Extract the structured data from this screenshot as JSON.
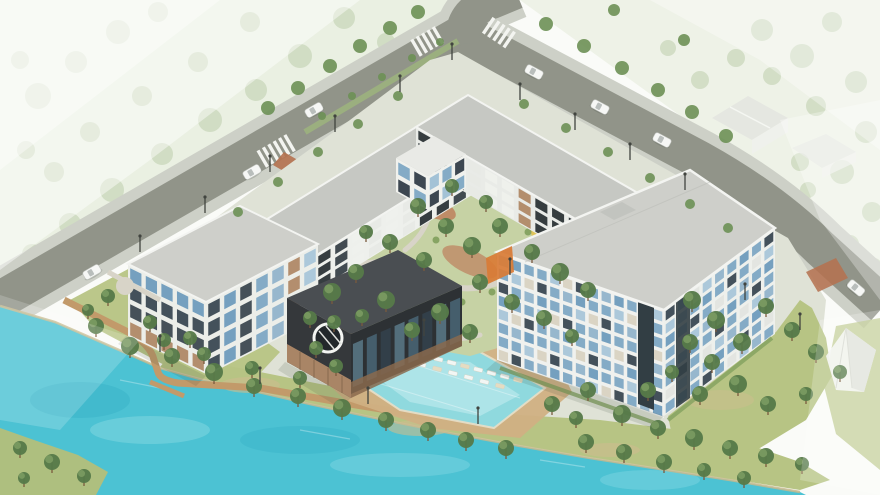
{
  "scene": {
    "type": "architectural-aerial-rendering",
    "description": "Isometric aerial rendering of a lakeside residential complex: U-shaped mid-rise buildings around a landscaped courtyard, dark clubhouse with round window, outdoor pool with loungers, turquoise lake with boardwalk, tree-lined boulevard with crosswalks and cars, faded context houses in mist",
    "features": [
      "lake",
      "swimming-pool",
      "pool-loungers",
      "lakeside-boardwalk",
      "dock",
      "courtyard-garden",
      "playground",
      "clubhouse-round-window",
      "west-residence-4-story",
      "courtyard-wings-3-story",
      "east-tower-8-story",
      "boulevard-with-median",
      "intersection-crosswalks",
      "brick-crossing",
      "street-lights",
      "cars",
      "event-tent",
      "context-houses",
      "misty-parkland"
    ],
    "trees": {
      "faded": [
        [
          38,
          96,
          13
        ],
        [
          76,
          62,
          11
        ],
        [
          118,
          32,
          12
        ],
        [
          158,
          12,
          10
        ],
        [
          210,
          120,
          12
        ],
        [
          162,
          154,
          11
        ],
        [
          112,
          190,
          12
        ],
        [
          70,
          224,
          11
        ],
        [
          32,
          254,
          10
        ],
        [
          256,
          90,
          11
        ],
        [
          300,
          56,
          12
        ],
        [
          344,
          18,
          11
        ],
        [
          386,
          42,
          9
        ],
        [
          142,
          96,
          10
        ],
        [
          198,
          62,
          10
        ],
        [
          250,
          22,
          10
        ],
        [
          90,
          132,
          10
        ],
        [
          54,
          172,
          10
        ],
        [
          26,
          150,
          9
        ],
        [
          20,
          60,
          9
        ],
        [
          762,
          30,
          11
        ],
        [
          802,
          56,
          12
        ],
        [
          832,
          22,
          10
        ],
        [
          856,
          82,
          11
        ],
        [
          816,
          106,
          10
        ],
        [
          866,
          132,
          11
        ],
        [
          842,
          172,
          12
        ],
        [
          872,
          212,
          10
        ],
        [
          800,
          162,
          9
        ],
        [
          772,
          76,
          9
        ],
        [
          736,
          58,
          9
        ],
        [
          746,
          162,
          8
        ],
        [
          850,
          244,
          9
        ],
        [
          874,
          266,
          8
        ],
        [
          808,
          190,
          8
        ],
        [
          700,
          80,
          9
        ],
        [
          668,
          48,
          8
        ]
      ],
      "street": [
        [
          268,
          108,
          7
        ],
        [
          298,
          88,
          7
        ],
        [
          330,
          66,
          7
        ],
        [
          360,
          46,
          7
        ],
        [
          390,
          28,
          7
        ],
        [
          418,
          12,
          7
        ],
        [
          322,
          116,
          4
        ],
        [
          352,
          96,
          4
        ],
        [
          382,
          77,
          4
        ],
        [
          412,
          58,
          4
        ],
        [
          440,
          42,
          4
        ],
        [
          238,
          212,
          5
        ],
        [
          278,
          182,
          5
        ],
        [
          318,
          152,
          5
        ],
        [
          358,
          124,
          5
        ],
        [
          398,
          96,
          5
        ],
        [
          546,
          24,
          7
        ],
        [
          584,
          46,
          7
        ],
        [
          622,
          68,
          7
        ],
        [
          658,
          90,
          7
        ],
        [
          692,
          112,
          7
        ],
        [
          726,
          136,
          7
        ],
        [
          614,
          10,
          6
        ],
        [
          684,
          40,
          6
        ],
        [
          524,
          104,
          5
        ],
        [
          566,
          128,
          5
        ],
        [
          608,
          152,
          5
        ],
        [
          650,
          178,
          5
        ],
        [
          690,
          204,
          5
        ],
        [
          728,
          228,
          5
        ]
      ],
      "site": [
        [
          332,
          292,
          9
        ],
        [
          356,
          272,
          8
        ],
        [
          386,
          300,
          9
        ],
        [
          362,
          316,
          7
        ],
        [
          412,
          330,
          8
        ],
        [
          440,
          312,
          9
        ],
        [
          470,
          332,
          8
        ],
        [
          334,
          322,
          7
        ],
        [
          418,
          206,
          8
        ],
        [
          446,
          226,
          8
        ],
        [
          472,
          246,
          9
        ],
        [
          500,
          226,
          8
        ],
        [
          532,
          252,
          8
        ],
        [
          560,
          272,
          9
        ],
        [
          588,
          290,
          8
        ],
        [
          480,
          282,
          8
        ],
        [
          512,
          302,
          8
        ],
        [
          452,
          186,
          7
        ],
        [
          486,
          202,
          7
        ],
        [
          390,
          242,
          8
        ],
        [
          366,
          232,
          7
        ],
        [
          424,
          260,
          8
        ],
        [
          544,
          318,
          8
        ],
        [
          572,
          336,
          7
        ],
        [
          96,
          326,
          8
        ],
        [
          130,
          346,
          9
        ],
        [
          172,
          356,
          8
        ],
        [
          214,
          372,
          9
        ],
        [
          254,
          386,
          8
        ],
        [
          150,
          322,
          7
        ],
        [
          190,
          338,
          7
        ],
        [
          298,
          396,
          8
        ],
        [
          342,
          408,
          9
        ],
        [
          386,
          420,
          8
        ],
        [
          428,
          430,
          8
        ],
        [
          300,
          378,
          7
        ],
        [
          252,
          368,
          7
        ],
        [
          204,
          354,
          7
        ],
        [
          164,
          340,
          7
        ],
        [
          466,
          440,
          8
        ],
        [
          506,
          448,
          8
        ],
        [
          586,
          442,
          8
        ],
        [
          624,
          452,
          8
        ],
        [
          664,
          462,
          8
        ],
        [
          704,
          470,
          7
        ],
        [
          744,
          478,
          7
        ],
        [
          622,
          414,
          9
        ],
        [
          658,
          428,
          8
        ],
        [
          694,
          438,
          9
        ],
        [
          730,
          448,
          8
        ],
        [
          766,
          456,
          8
        ],
        [
          802,
          464,
          7
        ],
        [
          588,
          390,
          8
        ],
        [
          648,
          390,
          8
        ],
        [
          552,
          404,
          8
        ],
        [
          576,
          418,
          7
        ],
        [
          692,
          300,
          9
        ],
        [
          716,
          320,
          9
        ],
        [
          742,
          342,
          9
        ],
        [
          690,
          342,
          8
        ],
        [
          712,
          362,
          8
        ],
        [
          738,
          384,
          9
        ],
        [
          768,
          404,
          8
        ],
        [
          700,
          394,
          8
        ],
        [
          672,
          372,
          7
        ],
        [
          766,
          306,
          8
        ],
        [
          792,
          330,
          8
        ],
        [
          816,
          352,
          8
        ],
        [
          840,
          372,
          7
        ],
        [
          806,
          394,
          7
        ],
        [
          20,
          448,
          7
        ],
        [
          52,
          462,
          8
        ],
        [
          84,
          476,
          7
        ],
        [
          24,
          478,
          6
        ],
        [
          316,
          348,
          7
        ],
        [
          336,
          366,
          7
        ],
        [
          310,
          318,
          7
        ],
        [
          108,
          296,
          7
        ],
        [
          88,
          310,
          6
        ]
      ],
      "shrubs": [
        [
          348,
          286
        ],
        [
          376,
          280
        ],
        [
          404,
          296
        ],
        [
          432,
          286
        ],
        [
          462,
          302
        ],
        [
          492,
          292
        ],
        [
          518,
          308
        ],
        [
          540,
          296
        ],
        [
          408,
          312
        ],
        [
          372,
          252
        ],
        [
          436,
          240
        ],
        [
          500,
          258
        ],
        [
          528,
          232
        ],
        [
          556,
          252
        ],
        [
          584,
          272
        ]
      ]
    },
    "cars": [
      [
        92,
        272,
        -30
      ],
      [
        252,
        172,
        -30
      ],
      [
        314,
        110,
        -30
      ],
      [
        534,
        72,
        28
      ],
      [
        600,
        107,
        28
      ],
      [
        662,
        140,
        28
      ],
      [
        856,
        288,
        40
      ]
    ],
    "street_lights": [
      [
        140,
        252
      ],
      [
        205,
        213
      ],
      [
        270,
        172
      ],
      [
        335,
        132
      ],
      [
        400,
        92
      ],
      [
        452,
        60
      ],
      [
        520,
        100
      ],
      [
        575,
        130
      ],
      [
        630,
        160
      ],
      [
        685,
        190
      ],
      [
        160,
        352
      ],
      [
        260,
        384
      ],
      [
        368,
        404
      ],
      [
        478,
        424
      ],
      [
        424,
        336
      ],
      [
        510,
        275
      ],
      [
        745,
        300
      ],
      [
        800,
        330
      ]
    ],
    "lounger_rows": [
      {
        "from": [
          372,
          342
        ],
        "to": [
          518,
          380
        ],
        "n": 12,
        "rot": 104
      },
      {
        "from": [
          390,
          356
        ],
        "to": [
          500,
          386
        ],
        "n": 8,
        "rot": 104
      }
    ],
    "facades": [
      {
        "name": "nw-wing-inner",
        "layer": "nw-wing-facades",
        "p0": [
          519,
          130
        ],
        "p1": [
          299,
          266
        ],
        "h": 36,
        "floors": 3,
        "cols": 13,
        "base": "#eef0ec",
        "cells": [
          "#2e3538",
          "#eef0ec",
          "#3a444a",
          "#e7e9e5",
          "#eef0ec",
          "#2e3538",
          "#e7e9e5"
        ],
        "seed": 1
      },
      {
        "name": "nw-wing-end",
        "layer": "nw-wing-facades",
        "p0": [
          243,
          234
        ],
        "p1": [
          299,
          266
        ],
        "h": 34,
        "floors": 3,
        "cols": 3,
        "base": "#eef0ec",
        "cells": [
          "#3a444a",
          "#e7e9e5",
          "#2e3538"
        ],
        "seed": 0
      },
      {
        "name": "ne-wing-inner",
        "layer": "ne-wing-facades",
        "p0": [
          416,
          127
        ],
        "p1": [
          650,
          262
        ],
        "h": 37,
        "floors": 3,
        "cols": 14,
        "base": "#e9ebe7",
        "cells": [
          "#2e3538",
          "#eef0ec",
          "#2e3538",
          "#e7e9e5",
          "#b08968",
          "#2e3538",
          "#eef0ec"
        ],
        "seed": 2
      },
      {
        "name": "court-block-sw",
        "layer": "court-block-facades",
        "p0": [
          396,
          158
        ],
        "p1": [
          428,
          176
        ],
        "h": 34,
        "floors": 2,
        "cols": 2,
        "base": "#f0f1ed",
        "cells": [
          "#7fa8c4",
          "#35404a"
        ],
        "seed": 0
      },
      {
        "name": "court-block-se",
        "layer": "court-block-facades",
        "p0": [
          428,
          176
        ],
        "p1": [
          466,
          154
        ],
        "h": 34,
        "floors": 2,
        "cols": 3,
        "base": "#f0f1ed",
        "cells": [
          "#7fa8c4",
          "#9fc0d4",
          "#35404a"
        ],
        "seed": 1
      },
      {
        "name": "tower-se",
        "layer": "big-facades",
        "p0": [
          664,
          310
        ],
        "p1": [
          775,
          228
        ],
        "h": 106,
        "floors": 8,
        "cols": 9,
        "base": "#eef0ec",
        "cells": [
          "#7fa8c4",
          "#6f9cbc",
          "#a9c6d8",
          "#3c4a54",
          "#7fa8c4",
          "#e2e4e0",
          "#7fa8c4",
          "#93b4cb"
        ],
        "seed": 3
      },
      {
        "name": "tower-sw",
        "layer": "big-facades",
        "p0": [
          497,
          252
        ],
        "p1": [
          664,
          310
        ],
        "h": 108,
        "floors": 8,
        "cols": 13,
        "base": "#f0f1ee",
        "cells": [
          "#7fa8c4",
          "#a9c6d8",
          "#6f9cbc",
          "#3c4a54",
          "#7fa8c4",
          "#93b4cb",
          "#d9d2c2",
          "#7fa8c4"
        ],
        "seed": 5
      },
      {
        "name": "west-sw",
        "layer": "west-facades",
        "p0": [
          128,
          264
        ],
        "p1": [
          206,
          302
        ],
        "h": 72,
        "floors": 4,
        "cols": 5,
        "base": "#eceee9",
        "cells": [
          "#3e4a52",
          "#6f9cbc",
          "#b08968",
          "#3c4a54",
          "#93b4cb"
        ],
        "seed": 1
      },
      {
        "name": "west-se",
        "layer": "west-facades",
        "p0": [
          206,
          302
        ],
        "p1": [
          318,
          244
        ],
        "h": 74,
        "floors": 4,
        "cols": 7,
        "base": "#eceee9",
        "cells": [
          "#3e4a52",
          "#b08968",
          "#6f9cbc",
          "#93b4cb",
          "#3c4a54",
          "#7fa8c4",
          "#a9c6d8"
        ],
        "seed": 4
      },
      {
        "name": "clubhouse-glass",
        "layer": "clubhouse-glass",
        "p0": [
          351,
          334
        ],
        "p1": [
          462,
          286
        ],
        "h": 60,
        "floors": 1,
        "cols": 8,
        "base": "#2d3134",
        "cells": [
          "#55707e",
          "#33404a",
          "#47606e"
        ],
        "seed": 0
      }
    ]
  },
  "palette": {
    "bg": "#fafbf8",
    "mist": "#ffffff",
    "fadeGround": "#e3ebd9",
    "fadedTree": "#b7c9a6",
    "streetTree": "#6d9055",
    "road": "#919489",
    "sidewalk": "#cdd0c7",
    "median": "#9db27e",
    "zebra": "#f3f4f0",
    "brick": "#b5714f",
    "siteBase": "#dfe2d6",
    "lawn": "#b7c484",
    "lawnPatch": "#cdbd8e",
    "courtGrass": "#c6d2a4",
    "mulch": "#bd7a58",
    "path": "#d8d4c8",
    "shrub": "#7f9f5c",
    "deck": "#d0b083",
    "deckLight": "#e8dcc0",
    "boardwalk": "#c29a6a",
    "poolWater": "#8fd9de",
    "poolLight": "#c6edf0",
    "lake": "#4cc2d3",
    "lakeLight": "#83d8e2",
    "lakeDeep": "#35aec6",
    "shoreSand": "#c7b98c",
    "peninsula": "#aebf7f",
    "roofLight": "#cecfca",
    "roofMid": "#c6c8c3",
    "parapet": "#f3f4f1",
    "facade": "#eef0ec",
    "winBlue": "#7fa8c4",
    "winLight": "#a9c6d8",
    "winDark": "#3c4a54",
    "wood": "#b08968",
    "woodDark": "#8a6a4e",
    "darkBuilding": "#35383b",
    "darkRoof": "#4a4e52",
    "glassDark": "#323e44",
    "accentOrange": "#d97b35",
    "accentYellow": "#e3c24d",
    "treeCanopy": "#567a49",
    "treeCanopyLight": "#7d9c63",
    "trunk": "#7a5a3e",
    "carBody": "#f6f7f5",
    "lightPole": "#41443f",
    "shadow": "#3c463c",
    "tent": "#f4f5f2",
    "tentShade": "#e3e5e0",
    "houseWall": "#f0f1ed",
    "houseRoof": "#e4e6e1"
  }
}
